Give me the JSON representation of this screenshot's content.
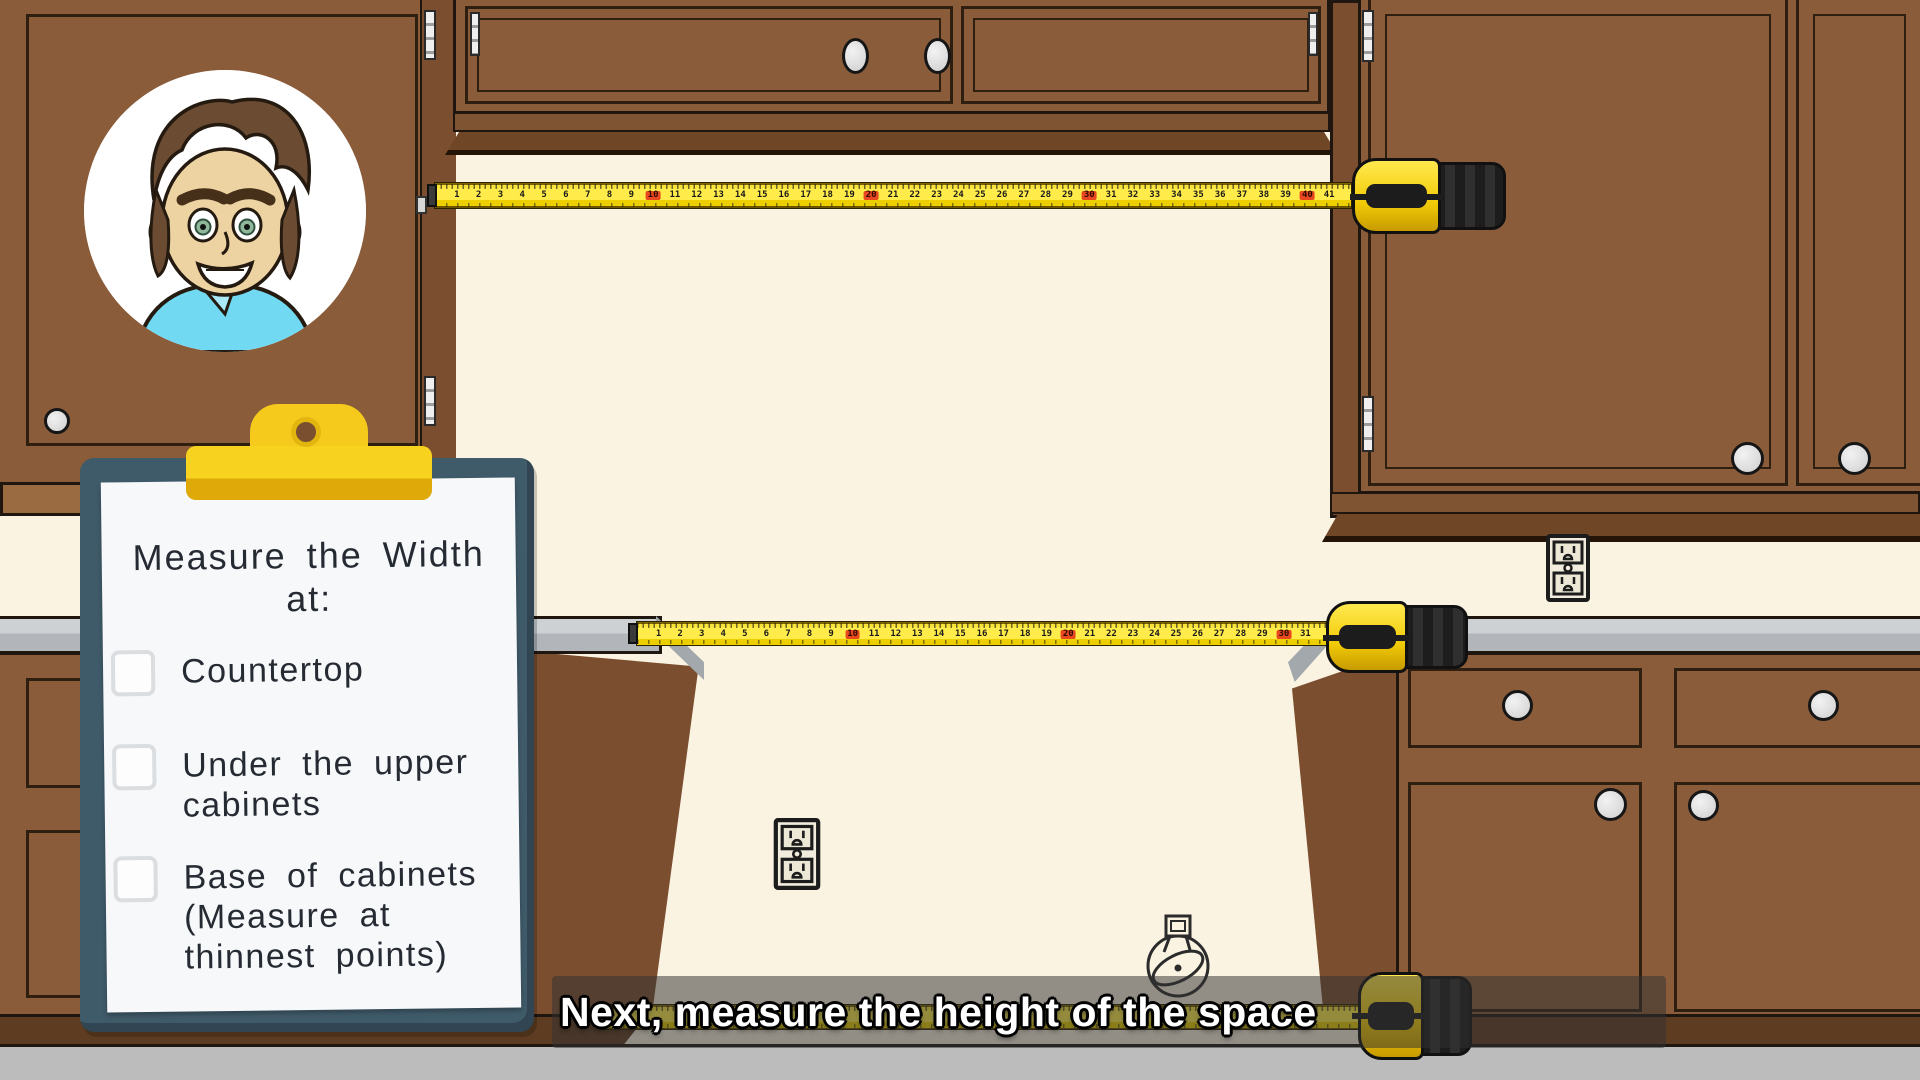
{
  "caption": {
    "text": "Next, measure the height of the space"
  },
  "clipboard": {
    "title": "Measure the Width\nat:",
    "items": [
      {
        "label": "Countertop",
        "checked": false
      },
      {
        "label": "Under the upper\ncabinets",
        "checked": false
      },
      {
        "label": "Base of cabinets\n(Measure at\nthinnest points)",
        "checked": false
      }
    ]
  },
  "tapes": {
    "top": {
      "numbers": [
        1,
        2,
        3,
        4,
        5,
        6,
        7,
        8,
        9,
        10,
        11,
        12,
        13,
        14,
        15,
        16,
        17,
        18,
        19,
        20,
        21,
        22,
        23,
        24,
        25,
        26,
        27,
        28,
        29,
        30,
        31,
        32,
        33,
        34,
        35,
        36,
        37,
        38,
        39,
        40,
        41
      ],
      "red": [
        10,
        20,
        30,
        40
      ]
    },
    "middle": {
      "numbers": [
        1,
        2,
        3,
        4,
        5,
        6,
        7,
        8,
        9,
        10,
        11,
        12,
        13,
        14,
        15,
        16,
        17,
        18,
        19,
        20,
        21,
        22,
        23,
        24,
        25,
        26,
        27,
        28,
        29,
        30,
        31
      ],
      "red": [
        10,
        20,
        30
      ]
    },
    "bottom": {
      "numbers": [],
      "red": []
    }
  },
  "icons": {
    "outlet": "power-outlet-icon",
    "ring": "ring-sketch-icon",
    "avatar": "presenter-avatar"
  },
  "colors": {
    "wall": "#FBF3E2",
    "cabinet_brown": "#8A5C3A",
    "cabinet_dark": "#6F4727",
    "counter_gray": "#C3C7CA",
    "floor_gray": "#BCBCBC",
    "tape_yellow": "#F6D906",
    "tape_red": "#E8471F",
    "clipboard_board": "#3F5A69",
    "clip_yellow": "#F2C51D",
    "paper_white": "#F6F8FA",
    "caption_text": "#FFFFFF"
  }
}
